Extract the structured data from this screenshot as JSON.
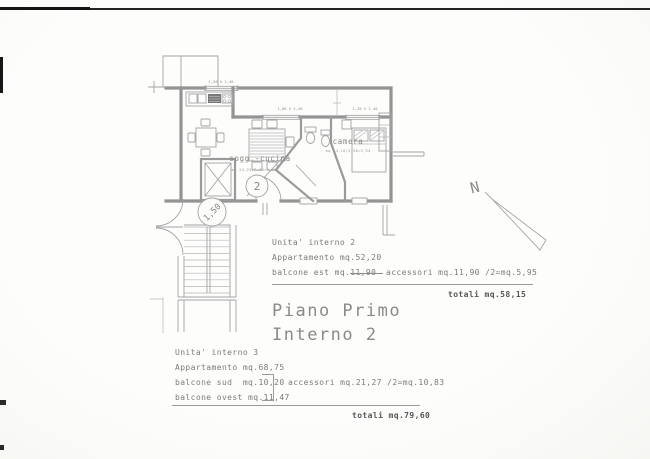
{
  "plan": {
    "rooms": {
      "living": {
        "name": "sogg.-cucina",
        "area_note": "mq 24,25/7,28=3,38"
      },
      "bedroom": {
        "name": "camera",
        "area_note": "mq 14,10/3,58=3,94"
      }
    },
    "markers": {
      "unit_circle": "2",
      "stair_landing": "1,50",
      "north": "N"
    },
    "dimensions": {
      "window_top": "1,20 h 2,40",
      "window_mid_left": "1,80 h 2,40",
      "window_mid_right": "1,20 h 2,40"
    }
  },
  "unit2_summary": {
    "title": "Unita' interno 2",
    "apartment": "Appartamento mq.52,20",
    "balcony_east": "balcone est mq.11,90",
    "accessories": "accessori mq.11,90 /2=mq.5,95",
    "total": "totali mq.58,15"
  },
  "sheet_title": {
    "line1": "Piano Primo",
    "line2": "Interno 2"
  },
  "unit3_summary": {
    "title": "Unita' interno 3",
    "apartment": "Appartamento mq.68,75",
    "balcony_south": "balcone sud  mq.10,20",
    "balcony_west": "balcone ovest mq.11,47",
    "accessories": "accessori mq.21,27 /2=mq.10,83",
    "total": "totali mq.79,60"
  },
  "colors": {
    "paper": "#fcfcfa",
    "line": "#9a9a9a",
    "text": "#7b7b7b",
    "scan_mark": "#1e1e1e"
  }
}
